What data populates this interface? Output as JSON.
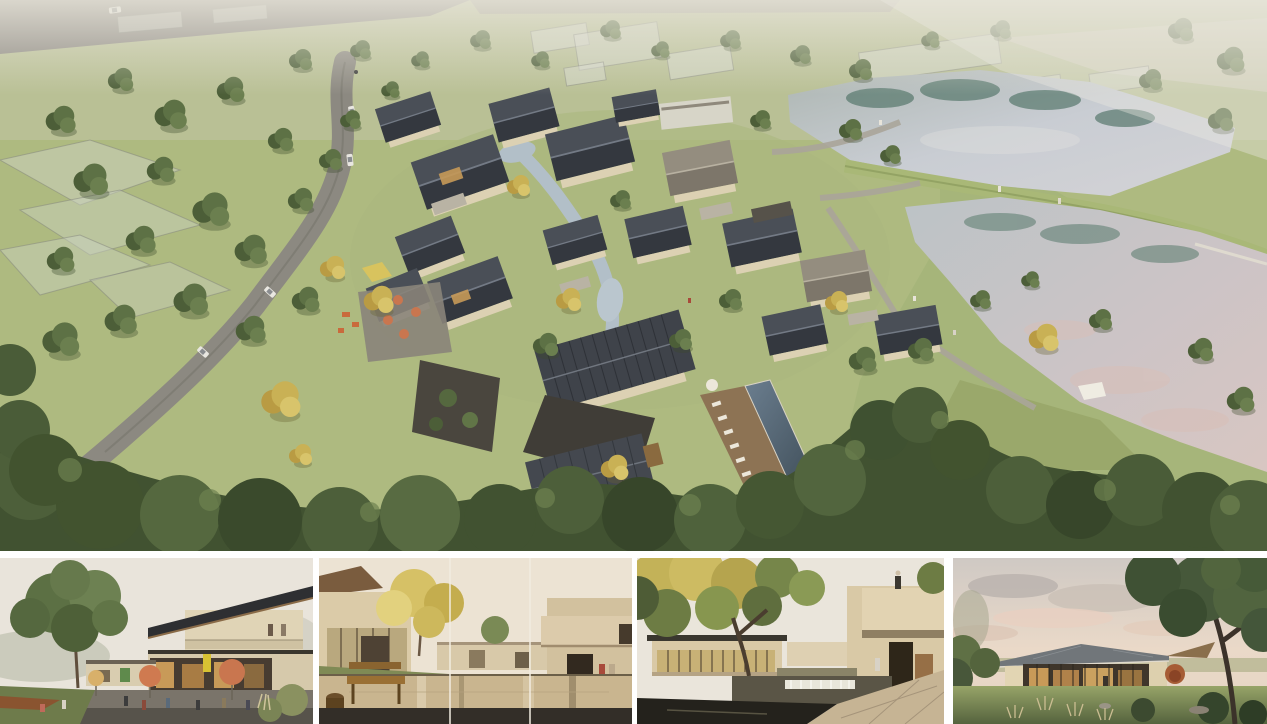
{
  "board": {
    "background": "#ffffff",
    "gap_color": "#ffffff",
    "aerial": {
      "label": "Aerial masterplan rendering of a courtyard-house village with winding stream, swimming pool, two ponds, curving access road and surrounding tree belt",
      "colors": {
        "meadow": "#aeba80",
        "tree_green": "#55693c",
        "tree_autumn": "#c9b155",
        "roof_dark": "#3f434a",
        "walls_cream": "#ddd2b4",
        "road_gray": "#8c8981",
        "stream_blue": "#b2bfc8",
        "pond_gray_blue": "#c7cbd1",
        "pond_pink_sheen": "#d6c3c0",
        "pond_teal_reflection": "#4f7265",
        "pool_blue": "#52626f",
        "deck_brown": "#8d7354",
        "umbrella_orange": "#c9764f"
      }
    },
    "thumbnails": [
      {
        "label": "Street-level view: two-storey clubhouse cafe with terrace umbrellas and visitors",
        "colors": {
          "sky": "#e9e4db",
          "building": "#d6c9ab",
          "roof": "#2e2f32",
          "umbrella": "#cf7a50",
          "pavement": "#7a746a"
        }
      },
      {
        "label": "Courtyard view: reflecting pond between houses with wooden bench and autumn tree",
        "colors": {
          "sky": "#ece3d3",
          "building": "#d2c19e",
          "pond": "#c9b58f",
          "bench": "#9a7034",
          "tree_autumn": "#d6c166"
        }
      },
      {
        "label": "Water court: weir cascade and pond below cantilevered guest house",
        "colors": {
          "sky": "#eae5db",
          "building": "#d9c9a6",
          "water": "#5a5546",
          "cascade": "#e8e6da",
          "stone": "#c6b494"
        }
      },
      {
        "label": "Dusk view: single-storey glass pavilion on a lawn framed by mature trees",
        "colors": {
          "sky": "#ddd5cf",
          "cloud_pink": "#e8cfc0",
          "roof": "#71767a",
          "glass_warm": "#c89a58",
          "lawn": "#8b9a63"
        }
      }
    ]
  }
}
